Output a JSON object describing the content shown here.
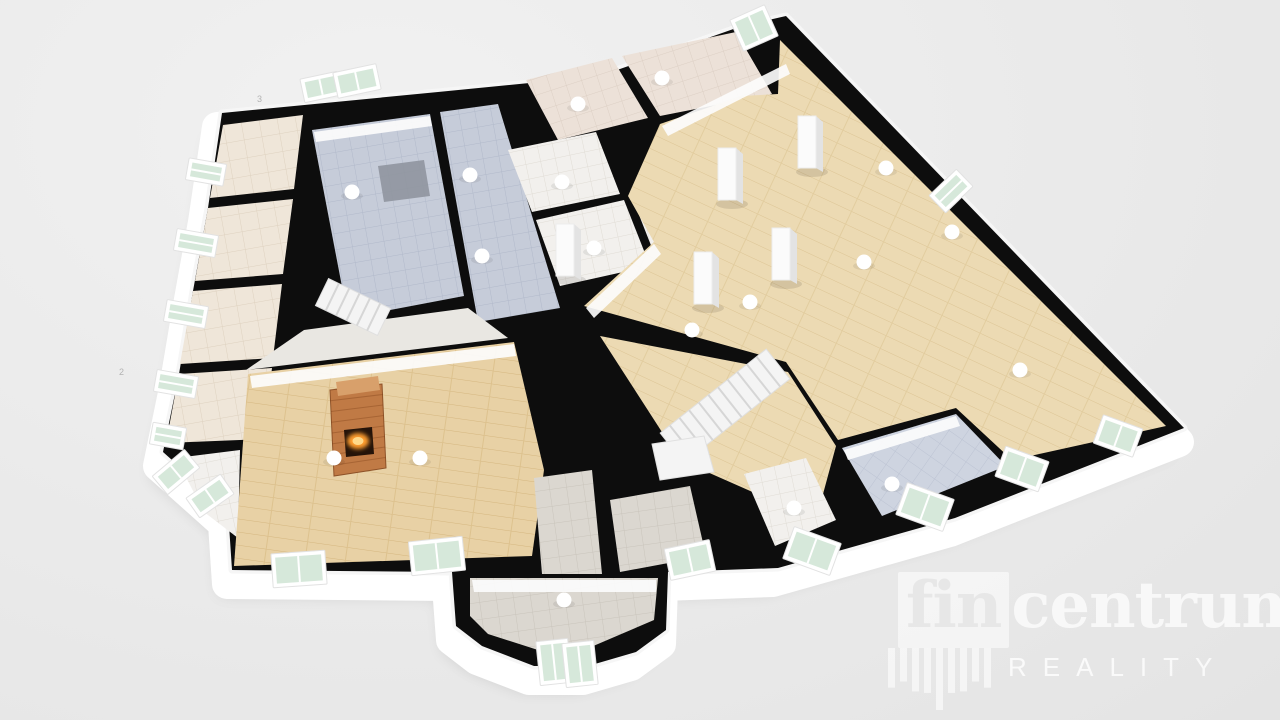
{
  "watermark": {
    "brand_fin": "fin",
    "brand_rest": "centrum",
    "reg": "®",
    "subtitle": "REALITY",
    "shield_bars": [
      64,
      54,
      70,
      58,
      74,
      58,
      70,
      54,
      64
    ]
  },
  "palette": {
    "wall": "#0d0d0d",
    "rim": "#ffffff",
    "halo": "#f6f6f6",
    "shadow": "rgba(0,0,0,0.13)",
    "beige": "pat:patBeige",
    "tileBlue": "pat:patBlue",
    "tilePink": "pat:patPink",
    "tileWhite": "pat:patWhite",
    "tileGray": "pat:patGray",
    "tileDiag": "pat:patDiag",
    "wood": "pat:patWood",
    "woodLiving": "pat:patWoodL",
    "lightfloor": "#e9e7e2",
    "wallface": "#fcfcfc",
    "mat": "#8f959f",
    "glass": "#d6e8da",
    "winframe": "#ffffff",
    "stair": "#f4f4f4",
    "stairline": "#d6d6d6",
    "brick": "#c07a45",
    "brickTop": "#d8a06b",
    "fireDark": "#241309",
    "fire": "#ff9d2f",
    "light": "#ffffff",
    "annot": "#9a9a9a"
  },
  "floorplan": {
    "hull": [
      [
        222,
        113
      ],
      [
        438,
        92
      ],
      [
        600,
        76
      ],
      [
        742,
        26
      ],
      [
        786,
        16
      ],
      [
        1184,
        428
      ],
      [
        955,
        518
      ],
      [
        778,
        568
      ],
      [
        668,
        572
      ],
      [
        666,
        630
      ],
      [
        636,
        652
      ],
      [
        588,
        666
      ],
      [
        534,
        666
      ],
      [
        482,
        646
      ],
      [
        456,
        626
      ],
      [
        452,
        572
      ],
      [
        232,
        570
      ],
      [
        228,
        510
      ],
      [
        163,
        452
      ],
      [
        179,
        374
      ],
      [
        193,
        291
      ],
      [
        208,
        208
      ]
    ],
    "rooms": [
      {
        "name": "room-left-1",
        "fill": "beige",
        "points": [
          [
            223,
            125
          ],
          [
            210,
            198
          ],
          [
            294,
            189
          ],
          [
            303,
            115
          ]
        ]
      },
      {
        "name": "room-left-2",
        "fill": "beige",
        "points": [
          [
            208,
            208
          ],
          [
            195,
            281
          ],
          [
            283,
            274
          ],
          [
            293,
            199
          ]
        ]
      },
      {
        "name": "room-left-3",
        "fill": "beige",
        "points": [
          [
            193,
            291
          ],
          [
            180,
            364
          ],
          [
            273,
            358
          ],
          [
            282,
            284
          ]
        ]
      },
      {
        "name": "room-left-4",
        "fill": "beige",
        "points": [
          [
            179,
            374
          ],
          [
            166,
            443
          ],
          [
            263,
            439
          ],
          [
            272,
            368
          ]
        ]
      },
      {
        "name": "room-corner",
        "fill": "tileWhite",
        "points": [
          [
            176,
            458
          ],
          [
            240,
            450
          ],
          [
            238,
            538
          ],
          [
            204,
            512
          ]
        ]
      },
      {
        "name": "garage",
        "fill": "tileBlue",
        "points": [
          [
            312,
            130
          ],
          [
            430,
            114
          ],
          [
            464,
            296
          ],
          [
            348,
            318
          ]
        ]
      },
      {
        "name": "corridor-blue",
        "fill": "tileBlue",
        "points": [
          [
            440,
            112
          ],
          [
            498,
            104
          ],
          [
            560,
            308
          ],
          [
            478,
            322
          ]
        ]
      },
      {
        "name": "room-top-a",
        "fill": "tilePink",
        "points": [
          [
            526,
            80
          ],
          [
            612,
            58
          ],
          [
            648,
            118
          ],
          [
            558,
            140
          ]
        ]
      },
      {
        "name": "room-top-b",
        "fill": "tilePink",
        "points": [
          [
            622,
            56
          ],
          [
            736,
            32
          ],
          [
            772,
            94
          ],
          [
            660,
            116
          ]
        ]
      },
      {
        "name": "bath-a",
        "fill": "tileWhite",
        "points": [
          [
            508,
            150
          ],
          [
            596,
            132
          ],
          [
            620,
            194
          ],
          [
            532,
            212
          ]
        ]
      },
      {
        "name": "bath-b",
        "fill": "tileWhite",
        "points": [
          [
            536,
            220
          ],
          [
            624,
            200
          ],
          [
            650,
            266
          ],
          [
            560,
            286
          ]
        ]
      },
      {
        "name": "bath-c",
        "fill": "tileWhite",
        "points": [
          [
            630,
            192
          ],
          [
            662,
            184
          ],
          [
            684,
            238
          ],
          [
            652,
            248
          ]
        ]
      },
      {
        "name": "great-hall",
        "fill": "wood",
        "points": [
          [
            780,
            40
          ],
          [
            1166,
            426
          ],
          [
            1012,
            460
          ],
          [
            956,
            408
          ],
          [
            838,
            440
          ],
          [
            786,
            362
          ],
          [
            584,
            306
          ],
          [
            654,
            242
          ],
          [
            628,
            196
          ],
          [
            660,
            124
          ],
          [
            742,
            96
          ],
          [
            778,
            94
          ]
        ]
      },
      {
        "name": "hall-south",
        "fill": "wood",
        "points": [
          [
            600,
            336
          ],
          [
            788,
            372
          ],
          [
            836,
            446
          ],
          [
            816,
            520
          ],
          [
            680,
            460
          ]
        ]
      },
      {
        "name": "landing-area",
        "fill": "lightfloor",
        "points": [
          [
            304,
            330
          ],
          [
            468,
            308
          ],
          [
            508,
            338
          ],
          [
            246,
            370
          ]
        ]
      },
      {
        "name": "living-room",
        "fill": "woodLiving",
        "points": [
          [
            248,
            374
          ],
          [
            514,
            342
          ],
          [
            544,
            470
          ],
          [
            532,
            556
          ],
          [
            234,
            566
          ]
        ]
      },
      {
        "name": "entry-hall",
        "fill": "tileGray",
        "points": [
          [
            470,
            578
          ],
          [
            658,
            578
          ],
          [
            654,
            620
          ],
          [
            584,
            650
          ],
          [
            538,
            650
          ],
          [
            488,
            634
          ],
          [
            470,
            616
          ]
        ]
      },
      {
        "name": "entry-stem",
        "fill": "tileGray",
        "points": [
          [
            534,
            478
          ],
          [
            592,
            470
          ],
          [
            602,
            574
          ],
          [
            542,
            574
          ]
        ]
      },
      {
        "name": "room-se-diag",
        "fill": "tileDiag",
        "points": [
          [
            842,
            448
          ],
          [
            956,
            414
          ],
          [
            1006,
            466
          ],
          [
            882,
            516
          ]
        ]
      },
      {
        "name": "room-se-gray",
        "fill": "tileWhite",
        "points": [
          [
            744,
            474
          ],
          [
            806,
            458
          ],
          [
            836,
            520
          ],
          [
            775,
            546
          ]
        ]
      },
      {
        "name": "room-s-gray",
        "fill": "tileGray",
        "points": [
          [
            610,
            500
          ],
          [
            690,
            486
          ],
          [
            706,
            556
          ],
          [
            620,
            572
          ]
        ]
      }
    ],
    "wallfaces": [
      {
        "points": [
          [
            250,
            376
          ],
          [
            514,
            344
          ],
          [
            516,
            356
          ],
          [
            252,
            388
          ]
        ]
      },
      {
        "points": [
          [
            586,
            308
          ],
          [
            654,
            244
          ],
          [
            661,
            254
          ],
          [
            594,
            318
          ]
        ]
      },
      {
        "points": [
          [
            662,
            126
          ],
          [
            786,
            64
          ],
          [
            790,
            74
          ],
          [
            668,
            136
          ]
        ]
      },
      {
        "points": [
          [
            314,
            132
          ],
          [
            430,
            116
          ],
          [
            432,
            126
          ],
          [
            316,
            142
          ]
        ]
      },
      {
        "points": [
          [
            844,
            450
          ],
          [
            956,
            416
          ],
          [
            960,
            426
          ],
          [
            848,
            460
          ]
        ]
      },
      {
        "points": [
          [
            472,
            580
          ],
          [
            656,
            580
          ],
          [
            656,
            592
          ],
          [
            474,
            592
          ]
        ]
      }
    ],
    "mats": [
      {
        "name": "garage-mat",
        "points": [
          [
            378,
            166
          ],
          [
            424,
            160
          ],
          [
            430,
            196
          ],
          [
            384,
            202
          ]
        ]
      }
    ],
    "stairs": [
      {
        "name": "main-staircase",
        "from": [
          778,
          364
        ],
        "to": [
          672,
          448
        ],
        "width": 38,
        "steps": 11
      },
      {
        "name": "side-staircase",
        "from": [
          322,
          292
        ],
        "to": [
          384,
          322
        ],
        "width": 30,
        "steps": 6
      }
    ],
    "stair_landings": [
      {
        "points": [
          [
            652,
            444
          ],
          [
            704,
            436
          ],
          [
            714,
            472
          ],
          [
            660,
            480
          ]
        ]
      }
    ],
    "fireplace": {
      "body": [
        [
          330,
          390
        ],
        [
          382,
          384
        ],
        [
          386,
          468
        ],
        [
          334,
          476
        ]
      ],
      "top": [
        [
          336,
          382
        ],
        [
          378,
          376
        ],
        [
          380,
          390
        ],
        [
          338,
          396
        ]
      ],
      "opening": [
        [
          344,
          430
        ],
        [
          372,
          427
        ],
        [
          374,
          454
        ],
        [
          346,
          457
        ]
      ],
      "fire": {
        "cx": 358,
        "cy": 441,
        "rx": 11,
        "ry": 8
      }
    },
    "pillars": [
      {
        "x": 718,
        "y": 148
      },
      {
        "x": 798,
        "y": 116
      },
      {
        "x": 694,
        "y": 252
      },
      {
        "x": 772,
        "y": 228
      },
      {
        "x": 556,
        "y": 224
      }
    ],
    "windows": [
      {
        "name": "skylight-1",
        "c": [
          321,
          87
        ],
        "a": -12,
        "w": 30,
        "h": 16
      },
      {
        "name": "skylight-2",
        "c": [
          357,
          81
        ],
        "a": -12,
        "w": 36,
        "h": 18
      },
      {
        "name": "window-top",
        "c": [
          754,
          28
        ],
        "a": -24,
        "w": 30,
        "h": 26
      },
      {
        "name": "window-left-1",
        "c": [
          206,
          172
        ],
        "a": -80,
        "w": 14,
        "h": 30
      },
      {
        "name": "window-left-2",
        "c": [
          196,
          243
        ],
        "a": -80,
        "w": 14,
        "h": 34
      },
      {
        "name": "window-left-3",
        "c": [
          186,
          314
        ],
        "a": -80,
        "w": 14,
        "h": 34
      },
      {
        "name": "window-left-4",
        "c": [
          176,
          384
        ],
        "a": -80,
        "w": 14,
        "h": 34
      },
      {
        "name": "window-left-5",
        "c": [
          168,
          436
        ],
        "a": -80,
        "w": 14,
        "h": 26
      },
      {
        "name": "window-sw-1",
        "c": [
          176,
          472
        ],
        "a": -40,
        "w": 34,
        "h": 16
      },
      {
        "name": "window-sw-2",
        "c": [
          210,
          496
        ],
        "a": -35,
        "w": 34,
        "h": 16
      },
      {
        "name": "window-living-1",
        "c": [
          299,
          569
        ],
        "a": -4,
        "w": 46,
        "h": 26
      },
      {
        "name": "window-living-2",
        "c": [
          437,
          556
        ],
        "a": -6,
        "w": 46,
        "h": 26
      },
      {
        "name": "bay-door-1",
        "c": [
          554,
          662
        ],
        "a": -6,
        "w": 24,
        "h": 36
      },
      {
        "name": "bay-door-2",
        "c": [
          580,
          664
        ],
        "a": -6,
        "w": 24,
        "h": 36
      },
      {
        "name": "window-s",
        "c": [
          690,
          560
        ],
        "a": -12,
        "w": 38,
        "h": 24
      },
      {
        "name": "window-se-1",
        "c": [
          812,
          551
        ],
        "a": 20,
        "w": 42,
        "h": 26
      },
      {
        "name": "window-se-2",
        "c": [
          925,
          507
        ],
        "a": 20,
        "w": 42,
        "h": 26
      },
      {
        "name": "window-se-3",
        "c": [
          1022,
          469
        ],
        "a": 20,
        "w": 38,
        "h": 24
      },
      {
        "name": "window-se-4",
        "c": [
          1118,
          436
        ],
        "a": 20,
        "w": 34,
        "h": 22
      },
      {
        "name": "window-ne",
        "c": [
          951,
          191
        ],
        "a": 46,
        "w": 16,
        "h": 30
      }
    ],
    "lights": [
      [
        352,
        192
      ],
      [
        470,
        175
      ],
      [
        482,
        256
      ],
      [
        562,
        182
      ],
      [
        594,
        248
      ],
      [
        662,
        78
      ],
      [
        578,
        104
      ],
      [
        886,
        168
      ],
      [
        952,
        232
      ],
      [
        864,
        262
      ],
      [
        1020,
        370
      ],
      [
        692,
        330
      ],
      [
        750,
        302
      ],
      [
        334,
        458
      ],
      [
        420,
        458
      ],
      [
        892,
        484
      ],
      [
        794,
        508
      ],
      [
        564,
        600
      ]
    ],
    "annotations": [
      {
        "p": [
          119,
          375
        ],
        "t": "2"
      },
      {
        "p": [
          257,
          102
        ],
        "t": "3"
      }
    ]
  }
}
